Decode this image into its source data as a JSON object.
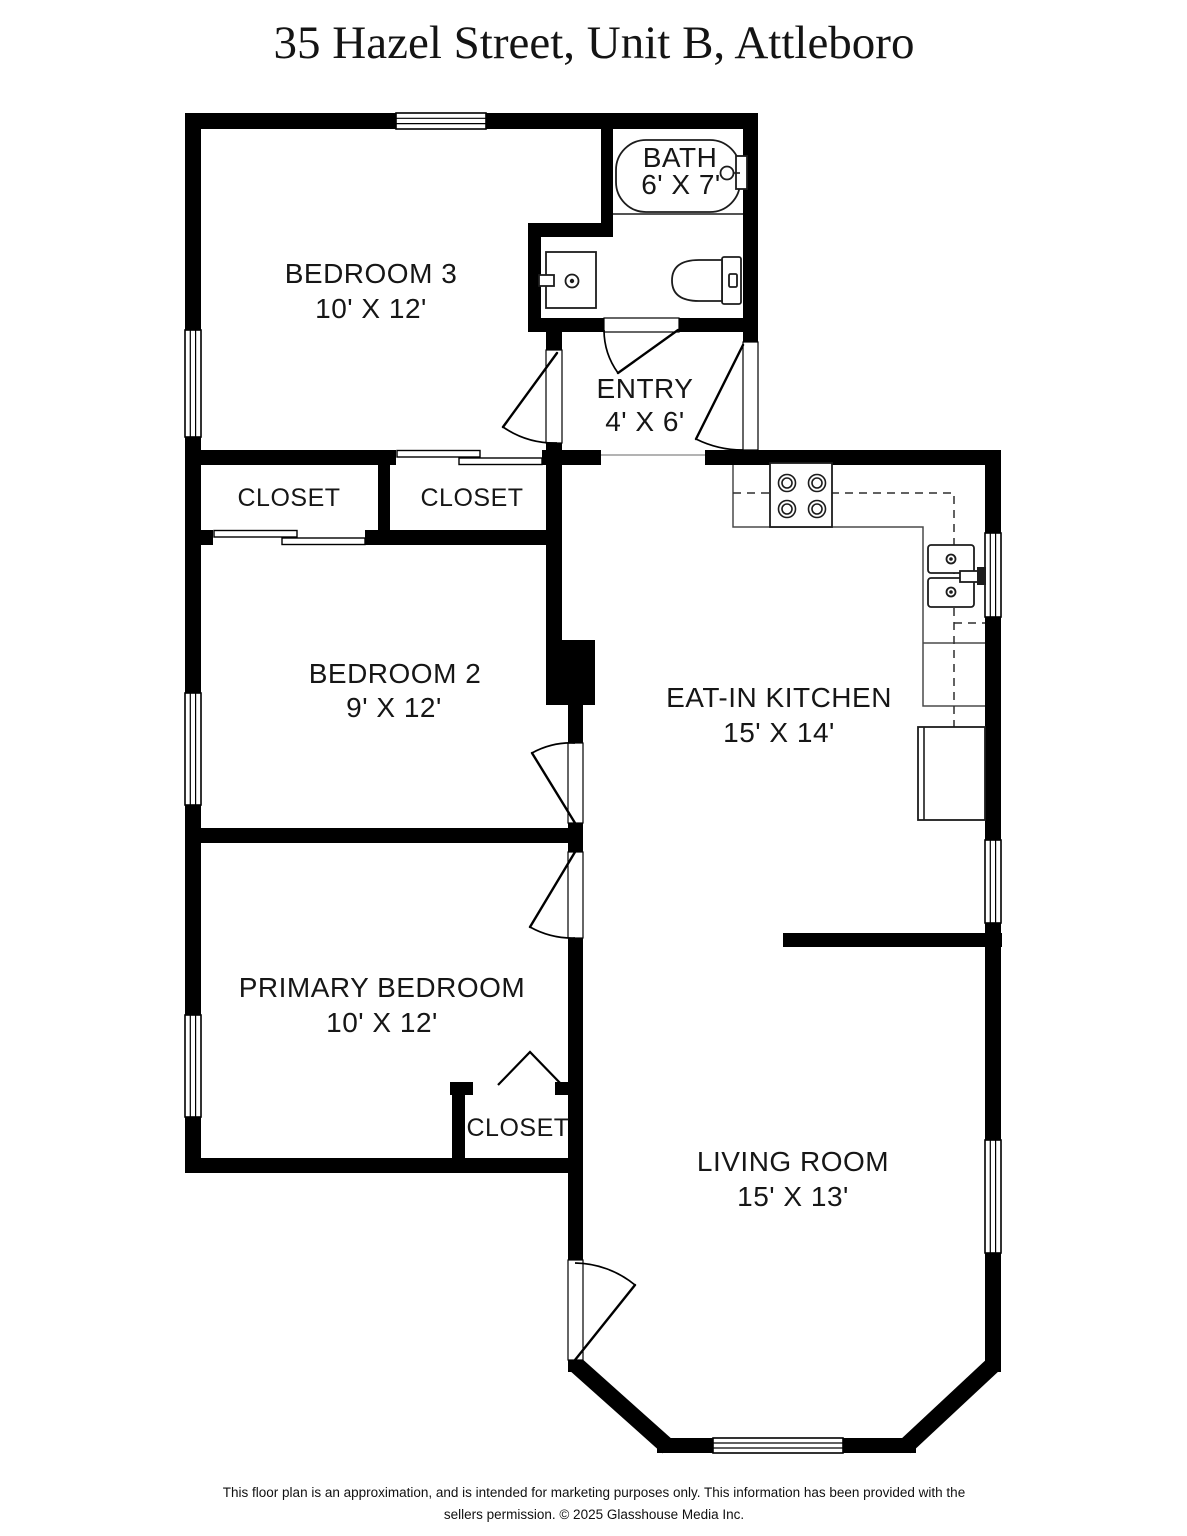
{
  "page": {
    "title": "35 Hazel Street, Unit B, Attleboro",
    "footer": {
      "line1": "This floor plan is an approximation, and is intended for marketing purposes only. This information has been provided with the",
      "line2": "sellers permission. © 2025 Glasshouse Media Inc."
    },
    "colors": {
      "background": "#ffffff",
      "walls": "#000000",
      "text": "#161616",
      "fixtures": "#1c1c1c"
    }
  },
  "rooms": {
    "bedroom3": {
      "name": "BEDROOM 3",
      "dims": "10' X 12'"
    },
    "bath": {
      "name": "BATH",
      "dims": "6' X 7'"
    },
    "entry": {
      "name": "ENTRY",
      "dims": "4' X 6'"
    },
    "closet_bedroom2": {
      "name": "CLOSET"
    },
    "closet_bedroom3": {
      "name": "CLOSET"
    },
    "bedroom2": {
      "name": "BEDROOM 2",
      "dims": "9' X 12'"
    },
    "kitchen": {
      "name": "EAT-IN KITCHEN",
      "dims": "15' X 14'"
    },
    "primary_bedroom": {
      "name": "PRIMARY BEDROOM",
      "dims": "10' X 12'"
    },
    "closet_primary": {
      "name": "CLOSET"
    },
    "living_room": {
      "name": "LIVING ROOM",
      "dims": "15' X 13'"
    }
  },
  "fixtures": {
    "bathtub": "bathtub",
    "toilet": "toilet",
    "bathroom_sink": "bathroom sink",
    "stove": "stove (4 burners)",
    "kitchen_sink": "double kitchen sink",
    "refrigerator": "refrigerator",
    "counter": "kitchen counter",
    "upper_cabinets": "upper cabinets (dashed)"
  }
}
